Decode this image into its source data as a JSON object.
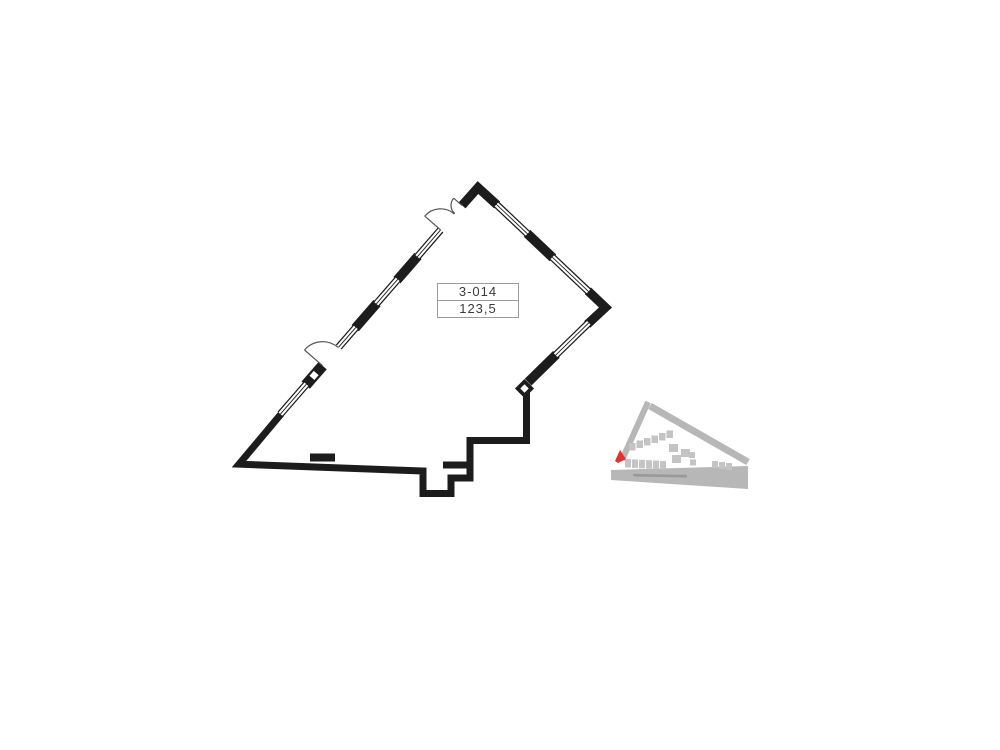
{
  "unit": {
    "number": "3-014",
    "area": "123,5"
  },
  "colors": {
    "wall": "#1c1c1c",
    "door_arc": "#555555",
    "label_border": "#9b9b9b",
    "label_text": "#3a3a3a",
    "road": "#b7b7b7",
    "building": "#c4c4c4",
    "marker_red": "#e3312e",
    "street_smudge": "#8f8f8f"
  },
  "icons": {
    "location_marker": "unit-location-marker",
    "diamond_column": "structural-column",
    "square_column": "structural-column"
  }
}
